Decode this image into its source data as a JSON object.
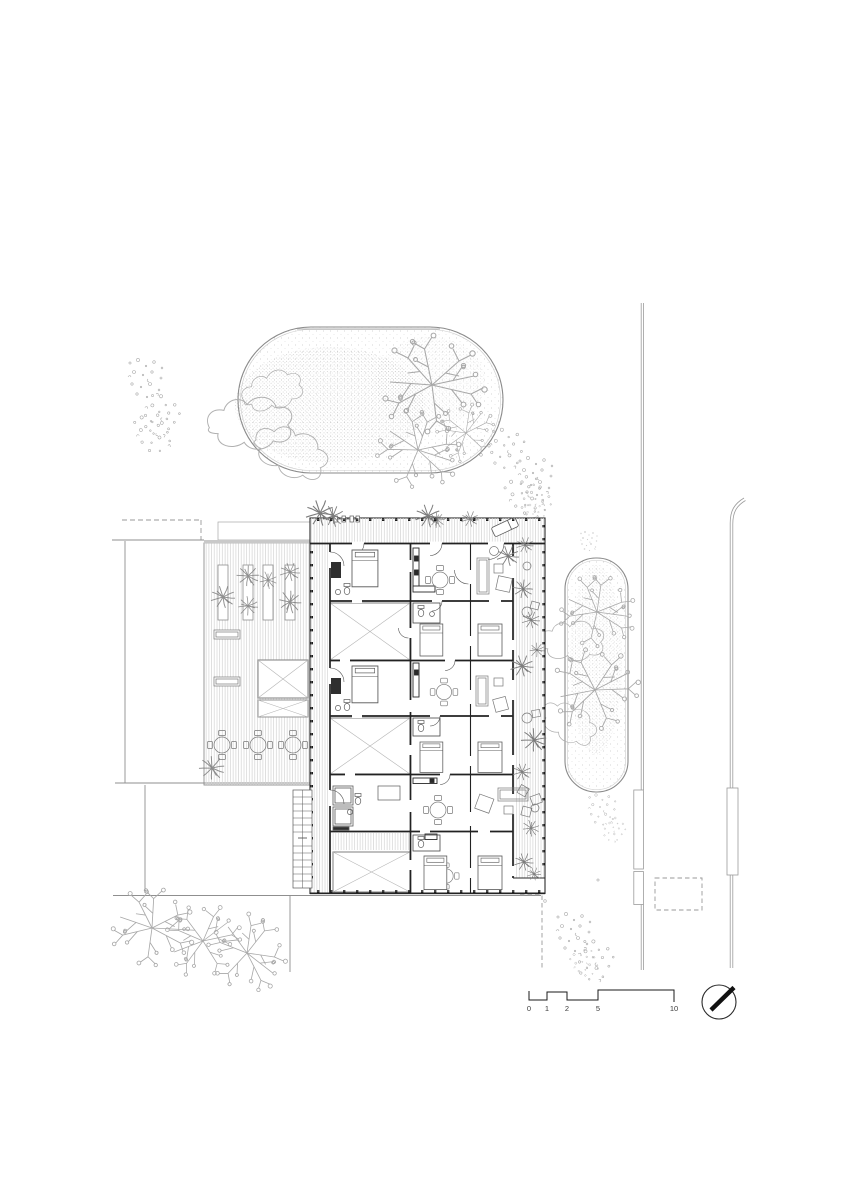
{
  "colors": {
    "ink": "#1f1f1f",
    "wall": "#222222",
    "site_line": "#8f8f8f",
    "vegetation": "#a3a3a3",
    "dense_plant": "#7d7d7d",
    "hatch": "#d4d4d4",
    "paper": "#ffffff"
  },
  "scalebar": {
    "labels": [
      "0",
      "1",
      "2",
      "5",
      "10"
    ]
  },
  "north_arrow": {
    "points_to": "north-east"
  }
}
